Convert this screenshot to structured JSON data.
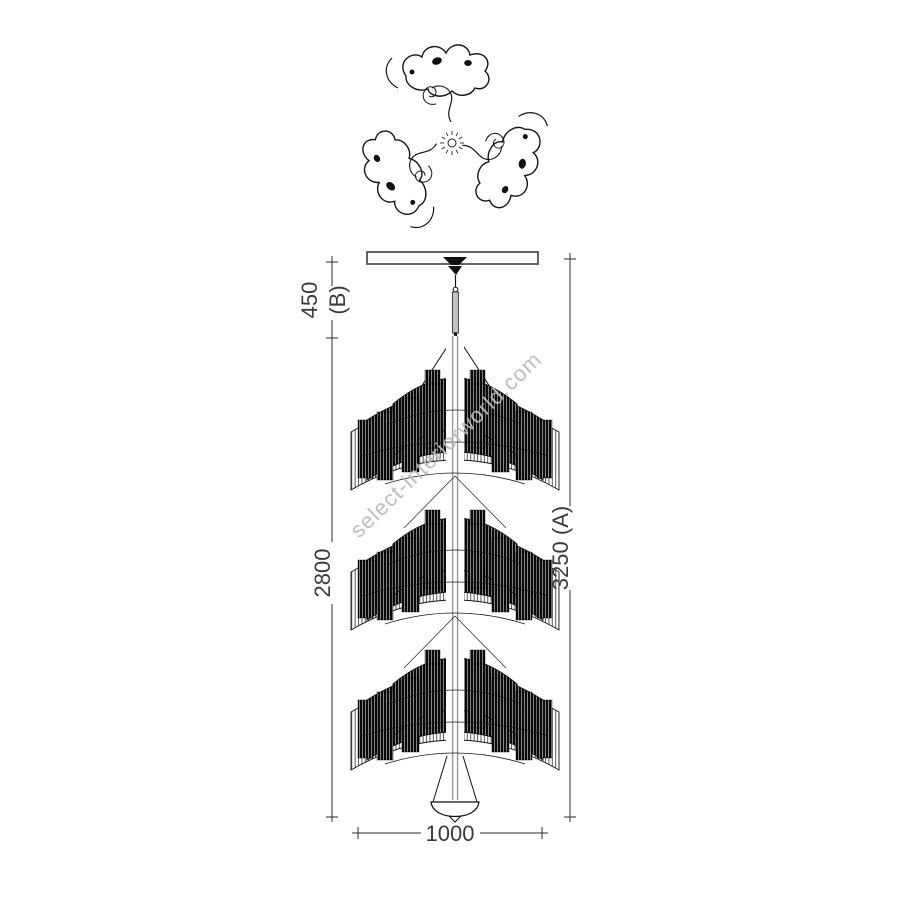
{
  "watermark": {
    "text": "select-interiorworld.com",
    "color": "#bcbcbc"
  },
  "dimensions": {
    "suspension": {
      "value": "450",
      "suffix": "(B)"
    },
    "body": {
      "value": "2800"
    },
    "total": {
      "value": "3250 (A)"
    },
    "width": {
      "value": "1000"
    }
  },
  "colors": {
    "line": "#141414",
    "rod": "#9a9a9a",
    "dimension_text": "#3b3b3b",
    "watermark": "#bcbcbc",
    "background": "#ffffff"
  }
}
